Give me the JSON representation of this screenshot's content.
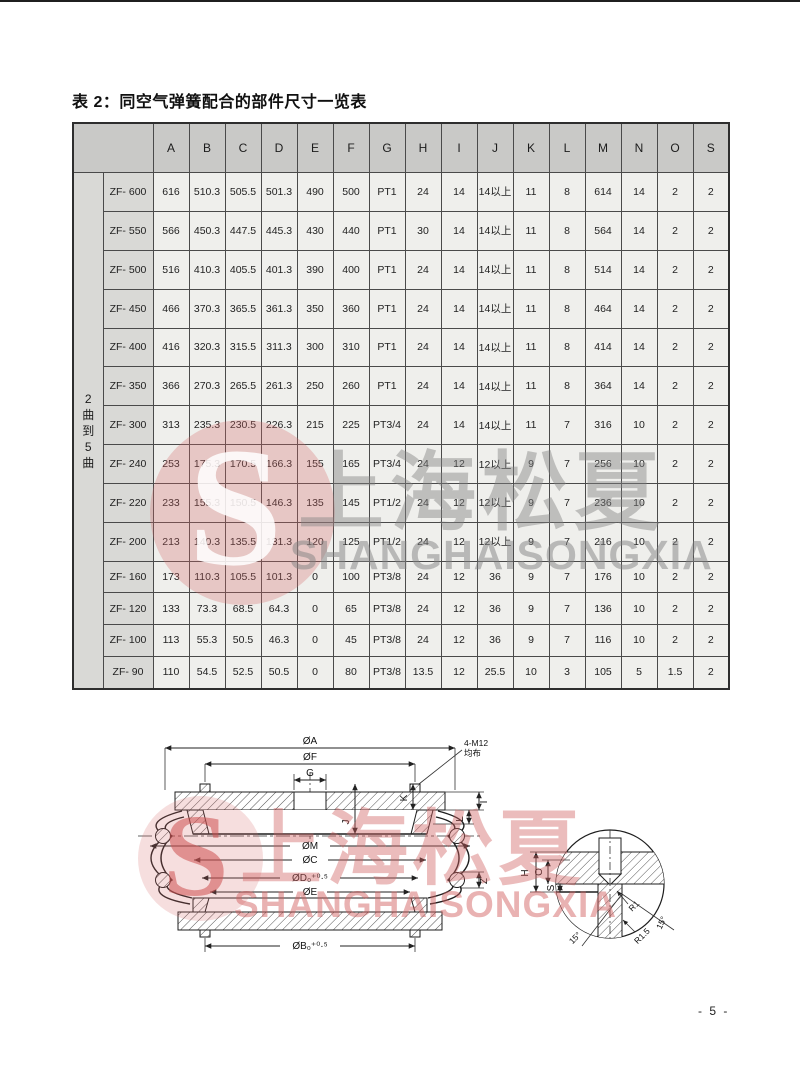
{
  "page": {
    "title": "表 2：同空气弹簧配合的部件尺寸一览表",
    "page_number": "- 5 -"
  },
  "table": {
    "columns": [
      "A",
      "B",
      "C",
      "D",
      "E",
      "F",
      "G",
      "H",
      "I",
      "J",
      "K",
      "L",
      "M",
      "N",
      "O",
      "S"
    ],
    "group_label": "2曲到5曲",
    "rows": [
      {
        "model": "ZF- 600",
        "values": [
          "616",
          "510.3",
          "505.5",
          "501.3",
          "490",
          "500",
          "PT1",
          "24",
          "14",
          "14以上",
          "11",
          "8",
          "614",
          "14",
          "2",
          "2"
        ]
      },
      {
        "model": "ZF- 550",
        "values": [
          "566",
          "450.3",
          "447.5",
          "445.3",
          "430",
          "440",
          "PT1",
          "30",
          "14",
          "14以上",
          "11",
          "8",
          "564",
          "14",
          "2",
          "2"
        ]
      },
      {
        "model": "ZF- 500",
        "values": [
          "516",
          "410.3",
          "405.5",
          "401.3",
          "390",
          "400",
          "PT1",
          "24",
          "14",
          "14以上",
          "11",
          "8",
          "514",
          "14",
          "2",
          "2"
        ]
      },
      {
        "model": "ZF- 450",
        "values": [
          "466",
          "370.3",
          "365.5",
          "361.3",
          "350",
          "360",
          "PT1",
          "24",
          "14",
          "14以上",
          "11",
          "8",
          "464",
          "14",
          "2",
          "2"
        ]
      },
      {
        "model": "ZF- 400",
        "values": [
          "416",
          "320.3",
          "315.5",
          "311.3",
          "300",
          "310",
          "PT1",
          "24",
          "14",
          "14以上",
          "11",
          "8",
          "414",
          "14",
          "2",
          "2"
        ]
      },
      {
        "model": "ZF- 350",
        "values": [
          "366",
          "270.3",
          "265.5",
          "261.3",
          "250",
          "260",
          "PT1",
          "24",
          "14",
          "14以上",
          "11",
          "8",
          "364",
          "14",
          "2",
          "2"
        ]
      },
      {
        "model": "ZF- 300",
        "values": [
          "313",
          "235.3",
          "230.5",
          "226.3",
          "215",
          "225",
          "PT3/4",
          "24",
          "14",
          "14以上",
          "11",
          "7",
          "316",
          "10",
          "2",
          "2"
        ]
      },
      {
        "model": "ZF- 240",
        "values": [
          "253",
          "175.3",
          "170.5",
          "166.3",
          "155",
          "165",
          "PT3/4",
          "24",
          "12",
          "12以上",
          "9",
          "7",
          "256",
          "10",
          "2",
          "2"
        ]
      },
      {
        "model": "ZF- 220",
        "values": [
          "233",
          "155.3",
          "150.5",
          "146.3",
          "135",
          "145",
          "PT1/2",
          "24",
          "12",
          "12以上",
          "9",
          "7",
          "236",
          "10",
          "2",
          "2"
        ]
      },
      {
        "model": "ZF- 200",
        "values": [
          "213",
          "140.3",
          "135.5",
          "131.3",
          "120",
          "125",
          "PT1/2",
          "24",
          "12",
          "12以上",
          "9",
          "7",
          "216",
          "10",
          "2",
          "2"
        ]
      },
      {
        "model": "ZF- 160",
        "values": [
          "173",
          "110.3",
          "105.5",
          "101.3",
          "0",
          "100",
          "PT3/8",
          "24",
          "12",
          "36",
          "9",
          "7",
          "176",
          "10",
          "2",
          "2"
        ]
      },
      {
        "model": "ZF- 120",
        "values": [
          "133",
          "73.3",
          "68.5",
          "64.3",
          "0",
          "65",
          "PT3/8",
          "24",
          "12",
          "36",
          "9",
          "7",
          "136",
          "10",
          "2",
          "2"
        ]
      },
      {
        "model": "ZF- 100",
        "values": [
          "113",
          "55.3",
          "50.5",
          "46.3",
          "0",
          "45",
          "PT3/8",
          "24",
          "12",
          "36",
          "9",
          "7",
          "116",
          "10",
          "2",
          "2"
        ]
      },
      {
        "model": "ZF- 90",
        "values": [
          "110",
          "54.5",
          "52.5",
          "50.5",
          "0",
          "80",
          "PT3/8",
          "13.5",
          "12",
          "25.5",
          "10",
          "3",
          "105",
          "5",
          "1.5",
          "2"
        ]
      }
    ]
  },
  "watermark": {
    "logo_letter": "S",
    "cn": "上海松夏",
    "en": "SHANGHAISONGXIA",
    "red": "#d56969",
    "gray": "#828282"
  },
  "diagram": {
    "dims": {
      "a": "ØA",
      "f": "ØF",
      "g": "G",
      "bolt1": "4-M12",
      "bolt2": "均布",
      "j": "J",
      "k": "K",
      "i": "I",
      "l": "L",
      "z": "Z",
      "m": "ØM",
      "c": "ØC",
      "d": "ØD₀⁺⁰·⁵",
      "e": "ØE",
      "b": "ØB₀⁺⁰·⁵"
    },
    "detail": {
      "h": "H",
      "o": "O",
      "s": "S",
      "r1": "R1",
      "r1_5": "R1.5",
      "angle_left": "15°",
      "angle_right": "15°"
    }
  }
}
